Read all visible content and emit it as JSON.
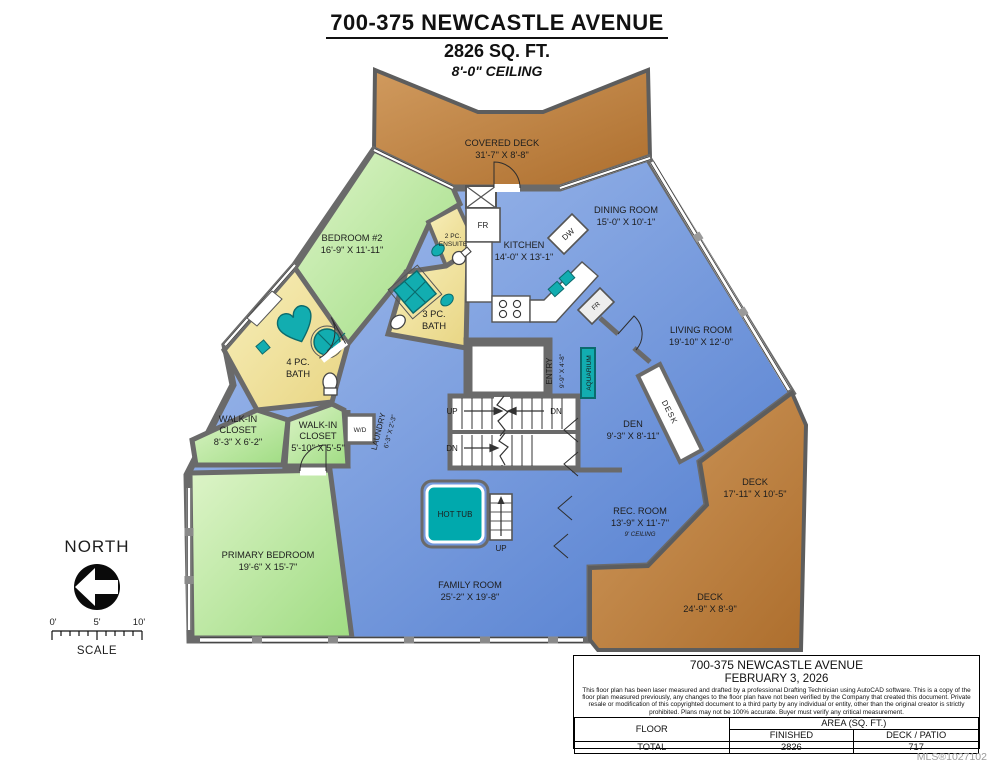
{
  "header": {
    "title": "700-375 NEWCASTLE AVENUE",
    "sqft": "2826 SQ. FT.",
    "ceiling": "8'-0\" CEILING"
  },
  "rooms": {
    "covered_deck": {
      "name": "COVERED DECK",
      "dims": "31'-7\" X 8'-8\""
    },
    "bedroom2": {
      "name": "BEDROOM #2",
      "dims": "16'-9\" X 11'-11\""
    },
    "ensuite": {
      "line1": "2 PC.",
      "line2": "ENSUITE"
    },
    "kitchen": {
      "name": "KITCHEN",
      "dims": "14'-0\" X 13'-1\""
    },
    "dining": {
      "name": "DINING ROOM",
      "dims": "15'-0\" X 10'-1\""
    },
    "living": {
      "name": "LIVING ROOM",
      "dims": "19'-10\" X 12'-0\""
    },
    "bath3": {
      "line1": "3 PC.",
      "line2": "BATH"
    },
    "bath4": {
      "line1": "4 PC.",
      "line2": "BATH"
    },
    "entry": {
      "name": "ENTRY",
      "dims": "9'-9\" X 4'-8\""
    },
    "aquarium": {
      "name": "AQUARIUM"
    },
    "den": {
      "name": "DEN",
      "dims": "9'-3\" X 8'-11\""
    },
    "desk": {
      "name": "DESK"
    },
    "wic1": {
      "line1": "WALK-IN",
      "line2": "CLOSET",
      "dims": "8'-3\" X 6'-2\""
    },
    "wic2": {
      "line1": "WALK-IN",
      "line2": "CLOSET",
      "dims": "5'-10\" X 5'-5\""
    },
    "laundry": {
      "name": "LAUNDRY",
      "dims": "6'-3\" X 2'-3\""
    },
    "primary": {
      "name": "PRIMARY BEDROOM",
      "dims": "19'-6\" X 15'-7\""
    },
    "family": {
      "name": "FAMILY ROOM",
      "dims": "25'-2\" X 19'-8\""
    },
    "rec": {
      "name": "REC. ROOM",
      "dims": "13'-9\" X 11'-7\"",
      "note": "9' CEILING"
    },
    "deck_right": {
      "name": "DECK",
      "dims": "17'-11\" X 10'-5\""
    },
    "deck_bottom": {
      "name": "DECK",
      "dims": "24'-9\" X 8'-9\""
    }
  },
  "fixtures": {
    "hot_tub": "HOT TUB",
    "wd": "W/D",
    "fridge": "FR",
    "fridge2": "FR",
    "dishwasher": "DW"
  },
  "stairs": {
    "up": "UP",
    "dn": "DN",
    "dn2": "DN",
    "up2": "UP"
  },
  "compass": {
    "label": "NORTH"
  },
  "scale_bar": {
    "t0": "0'",
    "t5": "5'",
    "t10": "10'",
    "label": "SCALE"
  },
  "title_block": {
    "address": "700-375 NEWCASTLE AVENUE",
    "date": "FEBRUARY 3, 2026",
    "disclaimer": "This floor plan has been laser measured and drafted by a professional Drafting Technician using AutoCAD software. This is a copy of the floor plan measured previously, any changes to the floor plan have not been verified by the Company that created this document.  Private resale or modification of this copyrighted document to a third party by any individual or entity, other than the original creator is strictly prohibited. Plans may not be 100% accurate.  Buyer must verify any critical measurement.",
    "table": {
      "floor": "FLOOR",
      "area": "AREA (SQ. FT.)",
      "finished": "FINISHED",
      "deck_patio": "DECK / PATIO",
      "total": "TOTAL",
      "finished_value": "2826",
      "deck_value": "717"
    }
  },
  "mls": "MLS®1027102",
  "colors": {
    "deck": "#b97a38",
    "room_blue": "#5b83d2",
    "room_green": "#a6e08a",
    "bath_yellow": "#ecd98d",
    "fixture_teal": "#12adb0",
    "wall_gray": "#6a6a6a"
  }
}
